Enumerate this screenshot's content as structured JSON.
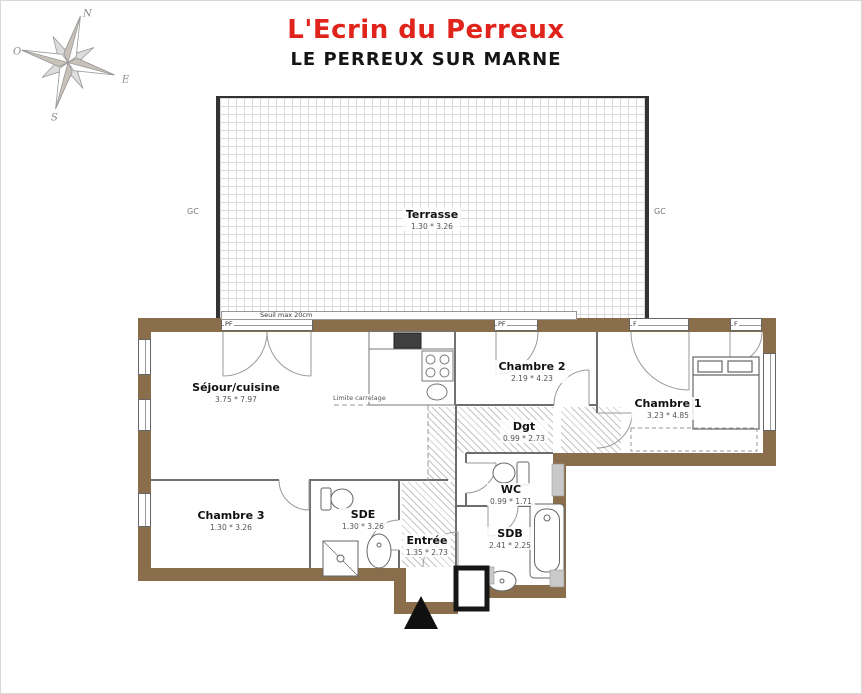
{
  "header": {
    "title": "L'Ecrin du Perreux",
    "subtitle": "LE PERREUX SUR MARNE"
  },
  "compass": {
    "north": "N",
    "south": "S",
    "east": "E",
    "west": "O"
  },
  "terrace": {
    "name": "Terrasse",
    "dims": "1.30 * 3.26",
    "gutter_left": "GC",
    "gutter_right": "GC",
    "threshold_note": "Seuil max 20cm"
  },
  "openings": {
    "pf_sejour": "PF",
    "pf_chambre2": "PF",
    "f_chambre1_left": "F",
    "f_chambre1_right": "F"
  },
  "rooms": {
    "sejour": {
      "name": "Séjour/cuisine",
      "dims": "3.75 * 7.97"
    },
    "chambre1": {
      "name": "Chambre 1",
      "dims": "3.23 * 4.85"
    },
    "chambre2": {
      "name": "Chambre 2",
      "dims": "2.19 * 4.23"
    },
    "chambre3": {
      "name": "Chambre 3",
      "dims": "1.30 * 3.26"
    },
    "degagement": {
      "name": "Dgt",
      "dims": "0.99 * 2.73"
    },
    "wc": {
      "name": "WC",
      "dims": "0.99 * 1.71"
    },
    "sde": {
      "name": "SDE",
      "dims": "1.30 * 3.26"
    },
    "sdb": {
      "name": "SDB",
      "dims": "2.41 * 2.25"
    },
    "entree": {
      "name": "Entrée",
      "dims": "1.35 * 2.73"
    }
  },
  "annotations": {
    "tile_limit": "Limite carrelage"
  },
  "colors": {
    "wall_brown": "#8a6d4b",
    "title_red": "#e0241c",
    "hatch_gray": "#c4c4c4"
  }
}
